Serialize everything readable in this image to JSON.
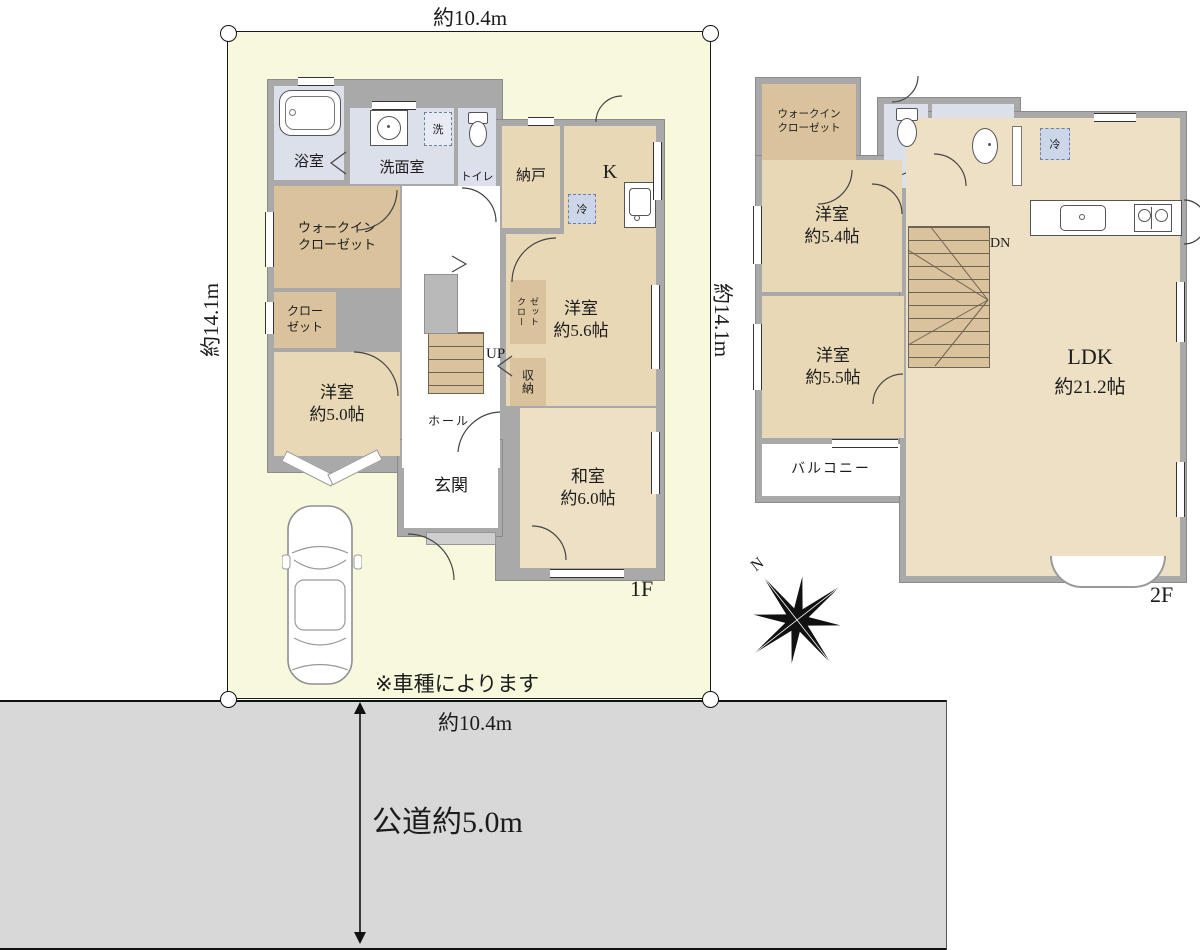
{
  "colors": {
    "lot_fill": "#f8f8dc",
    "road_fill": "#d8d8d8",
    "wall_gray": "#a9a9a9",
    "room_tan": "#e9d8b6",
    "closet_tan": "#d9c29c",
    "tatami_tan": "#eee0c4",
    "wet_blue": "#dce0eb",
    "fridge_blue": "#cdd6e8"
  },
  "site": {
    "top_width": "約10.4m",
    "bottom_width": "約10.4m",
    "left_height": "約14.1m",
    "right_height": "約14.1m",
    "road_label": "公道約5.0m",
    "car_note": "※車種によります",
    "compass_north": "N"
  },
  "floor1": {
    "label": "1F",
    "bath": "浴室",
    "washroom": "洗面室",
    "laundry": "洗",
    "toilet": "トイレ",
    "storeroom": "納戸",
    "kitchen": "K",
    "fridge": "冷",
    "wic_line1": "ウォークイン",
    "wic_line2": "クローゼット",
    "closet_line1": "クロー",
    "closet_line2": "ゼット",
    "closet2_line1": "クロー",
    "closet2_line2": "ゼット",
    "storage": "収納",
    "hall": "ホール",
    "stairs_label": "UP",
    "entrance": "玄関",
    "west_room": {
      "name": "洋室",
      "size": "約5.0帖"
    },
    "mid_room": {
      "name": "洋室",
      "size": "約5.6帖"
    },
    "tatami_room": {
      "name": "和室",
      "size": "約6.0帖"
    }
  },
  "floor2": {
    "label": "2F",
    "wic_line1": "ウォークイン",
    "wic_line2": "クローゼット",
    "toilet": "トイレ",
    "fridge": "冷",
    "stairs_label": "DN",
    "balcony": "バルコニー",
    "room_a": {
      "name": "洋室",
      "size": "約5.4帖"
    },
    "room_b": {
      "name": "洋室",
      "size": "約5.5帖"
    },
    "ldk": {
      "name": "LDK",
      "size": "約21.2帖"
    }
  }
}
